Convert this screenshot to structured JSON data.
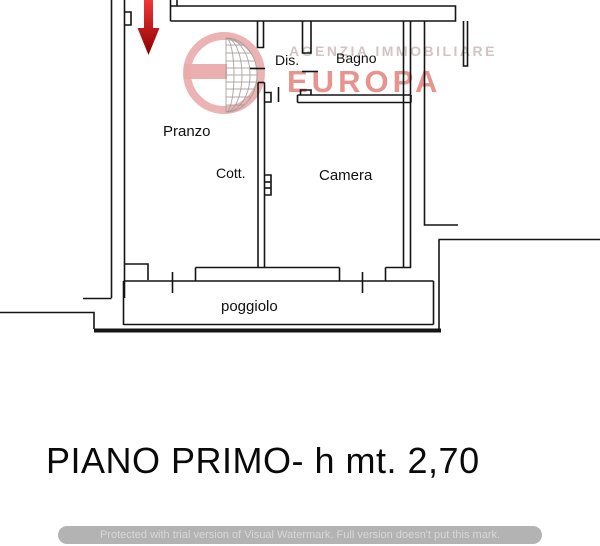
{
  "window": {
    "width": 600,
    "height": 546,
    "background": "#ffffff"
  },
  "floor_plan": {
    "wall_color": "#141414",
    "entrance_arrow_color": "#cc1111",
    "labels": {
      "dis": "Dis.",
      "bagno": "Bagno",
      "pranzo": "Pranzo",
      "cott": "Cott.",
      "camera": "Camera",
      "poggiolo": "poggiolo"
    }
  },
  "caption": {
    "text": "PIANO PRIMO- h mt. 2,70",
    "color": "#0a0a0a"
  },
  "watermarks": {
    "agency_logo": {
      "top_line": "AGENZIA IMMOBILIARE",
      "name": "EUROPA",
      "ring_color": "#eaabab",
      "top_line_color": "#d5c3c3",
      "name_color": "#e27a74",
      "globe_line_color": "#a39b9b"
    },
    "trial_banner": {
      "text": "Protected with trial version of Visual Watermark. Full version doesn't put this mark.",
      "bar_color": "#b3b3b3",
      "text_color": "#d8d8d8"
    }
  }
}
